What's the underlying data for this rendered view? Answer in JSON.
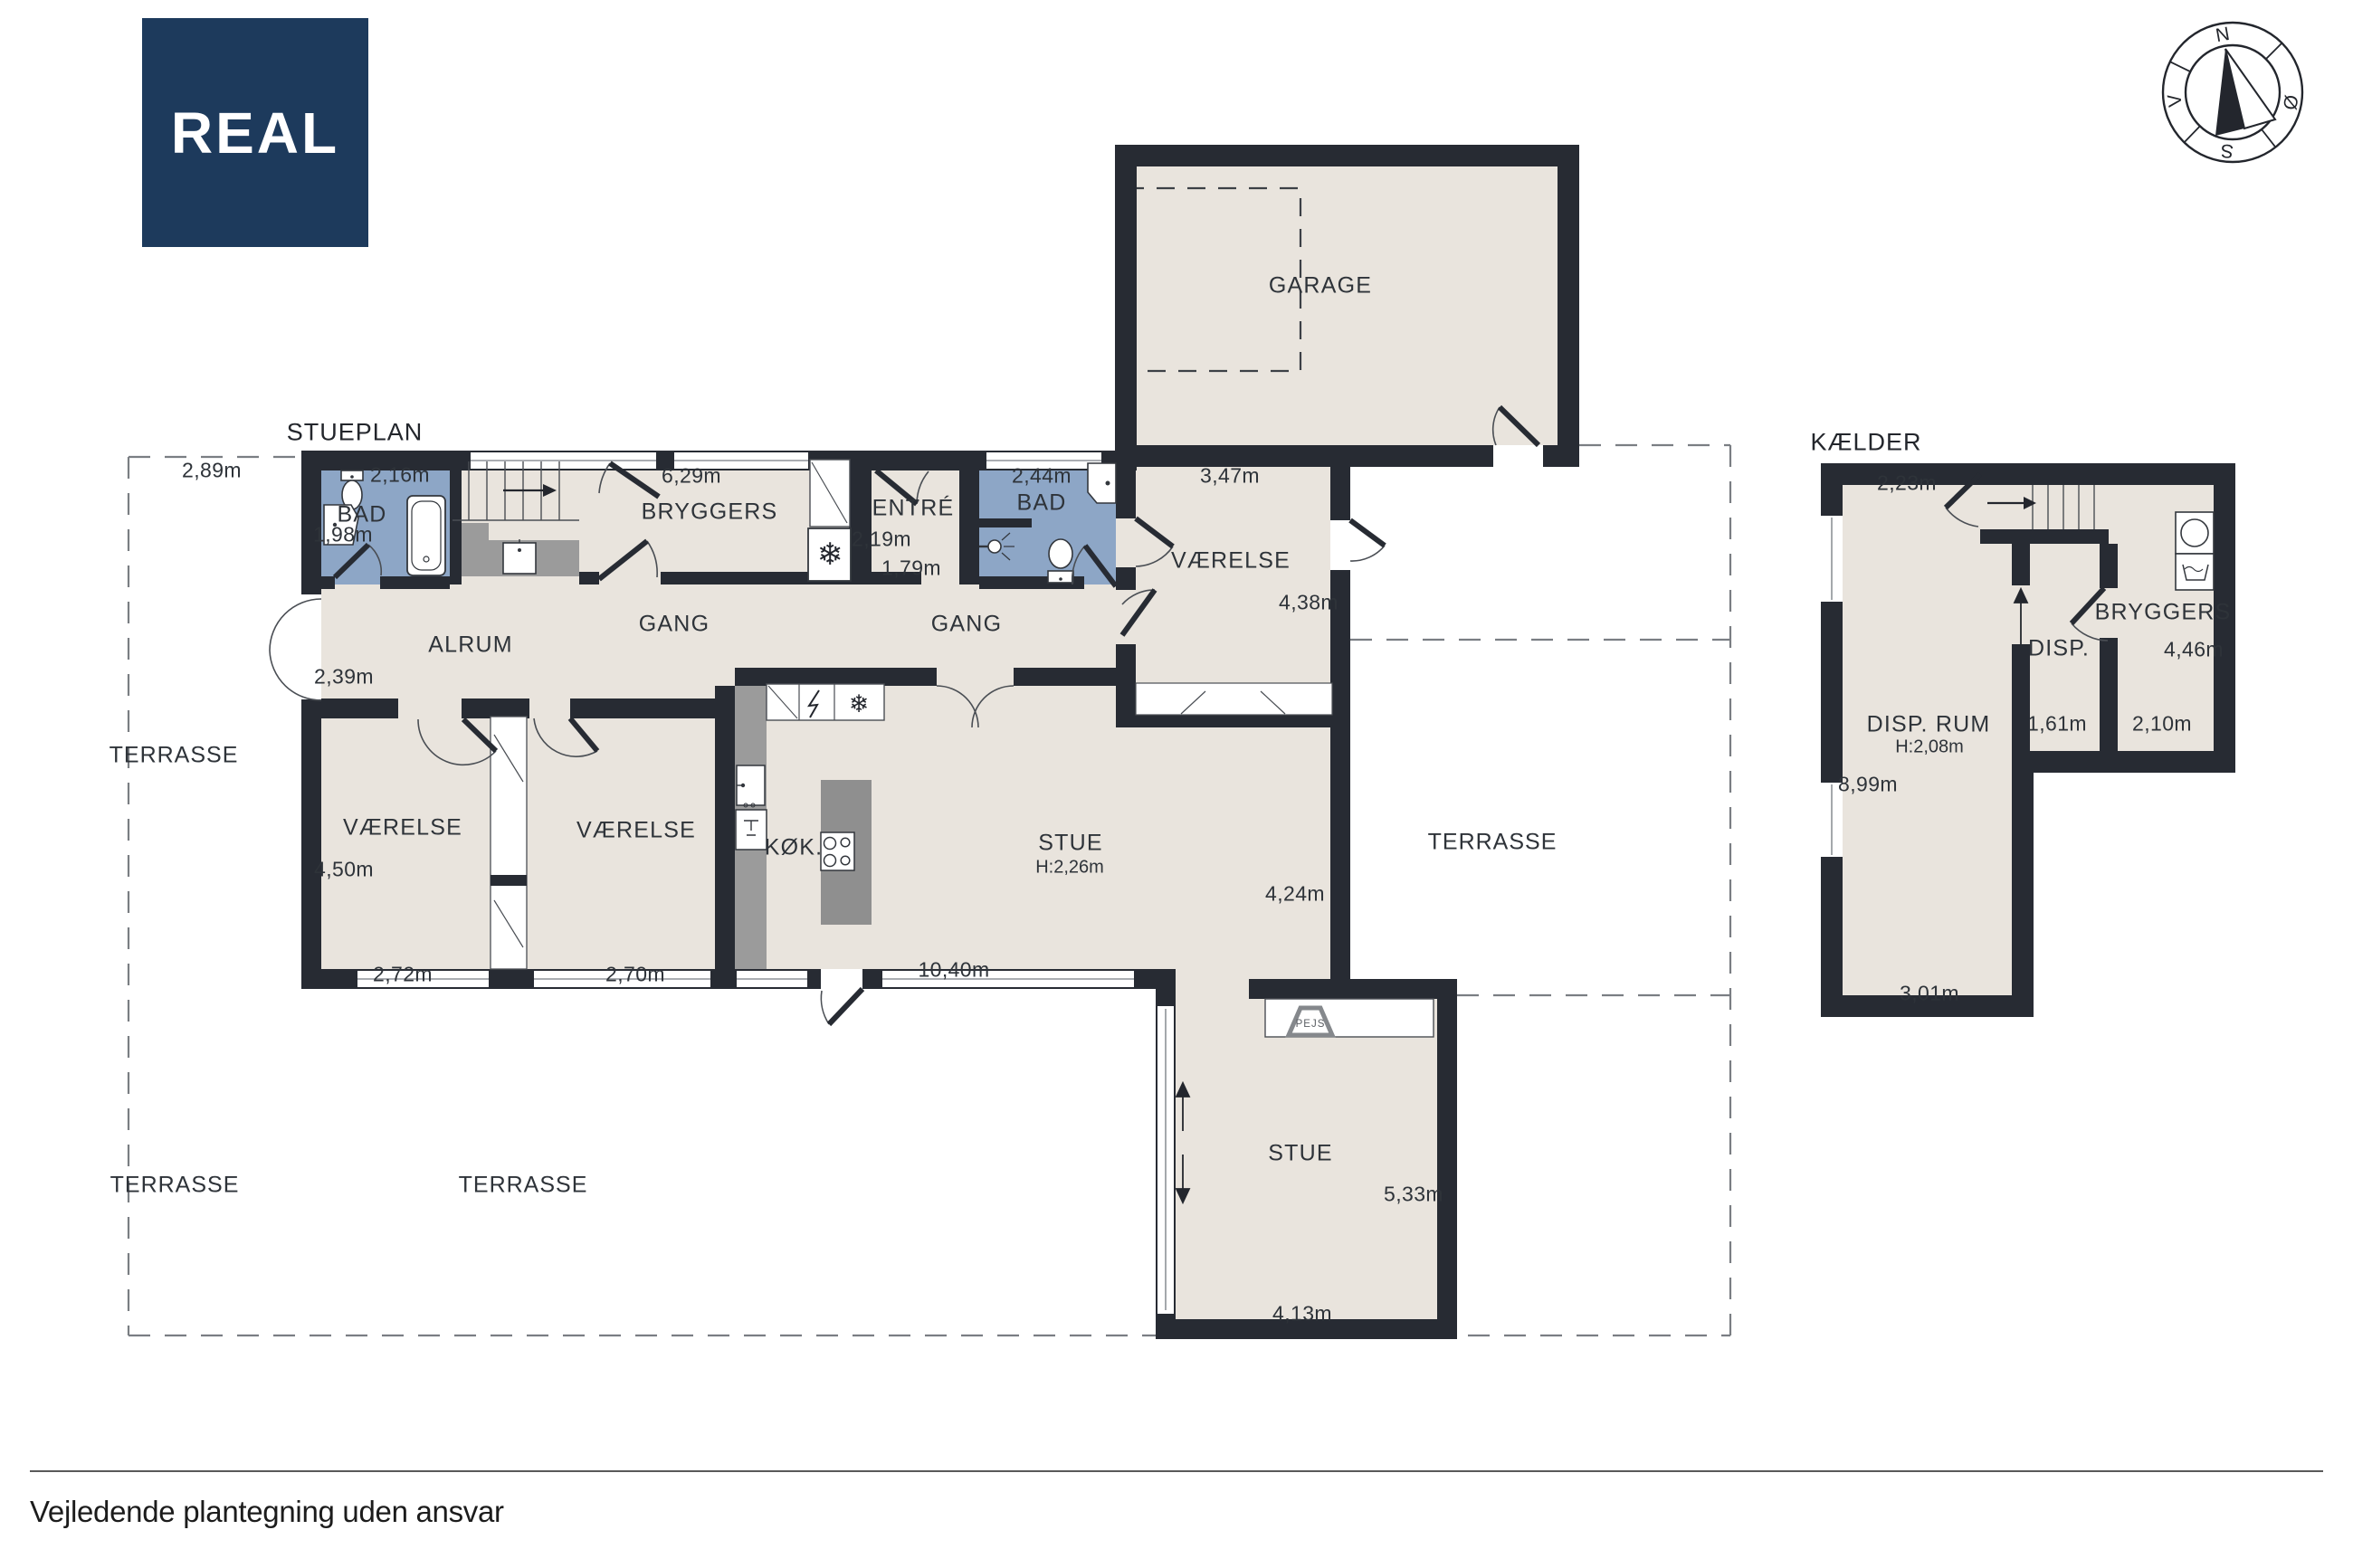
{
  "page": {
    "footer": "Vejledende plantegning uden ansvar"
  },
  "logo": {
    "text": "REAL",
    "bg_color": "#1d3a5c",
    "fg_color": "#ffffff"
  },
  "compass": {
    "north": "N",
    "east": "Ø",
    "south": "S",
    "west": "V"
  },
  "colors": {
    "wall": "#272b33",
    "floor": "#e9e4dd",
    "bath": "#8da6c6",
    "counter": "#9b9b9b",
    "island": "#8f8f8f",
    "dash": "#7a7e83"
  },
  "stueplan": {
    "title": "STUEPLAN",
    "rooms": {
      "bad1": "BAD",
      "bryggers": "BRYGGERS",
      "entre": "ENTRÉ",
      "bad2": "BAD",
      "vaerelse_ne": "VÆRELSE",
      "garage": "GARAGE",
      "alrum": "ALRUM",
      "gang_left": "GANG",
      "gang_right": "GANG",
      "vaerelse_sw": "VÆRELSE",
      "vaerelse_s": "VÆRELSE",
      "koek": "KØK.",
      "stue_upper": "STUE",
      "stue_upper_height": "H:2,26m",
      "stue_lower": "STUE",
      "pejs": "PEJS",
      "terrasse_nw": "TERRASSE",
      "terrasse_sw": "TERRASSE",
      "terrasse_s": "TERRASSE",
      "terrasse_e": "TERRASSE"
    },
    "measurements": {
      "m_terrace_w": "2,89m",
      "m_bad1_w": "2,16m",
      "m_bad1_h": "1,98m",
      "m_bryggers_w": "6,29m",
      "m_entre_w": "2,19m",
      "m_entre_h": "1,79m",
      "m_bad2_w": "2,44m",
      "m_vaerelse_ne_w": "3,47m",
      "m_vaerelse_ne_h": "4,38m",
      "m_alrum_h": "2,39m",
      "m_vaerelse_sw_h": "4,50m",
      "m_vaerelse_sw_w": "2,72m",
      "m_vaerelse_s_w": "2,70m",
      "m_stue_w": "10,40m",
      "m_stue_h": "4,24m",
      "m_stue2_h": "5,33m",
      "m_stue2_w": "4,13m"
    }
  },
  "kaelder": {
    "title": "KÆLDER",
    "rooms": {
      "disp_rum": "DISP. RUM",
      "disp_rum_height": "H:2,08m",
      "disp": "DISP.",
      "bryggers": "BRYGGERS"
    },
    "measurements": {
      "m_stairs_w": "2,23m",
      "m_disp_rum_h": "8,99m",
      "m_disp_rum_w": "3,01m",
      "m_disp_w": "1,61m",
      "m_bryggers_w": "2,10m",
      "m_bryggers_h": "4,46m"
    }
  }
}
